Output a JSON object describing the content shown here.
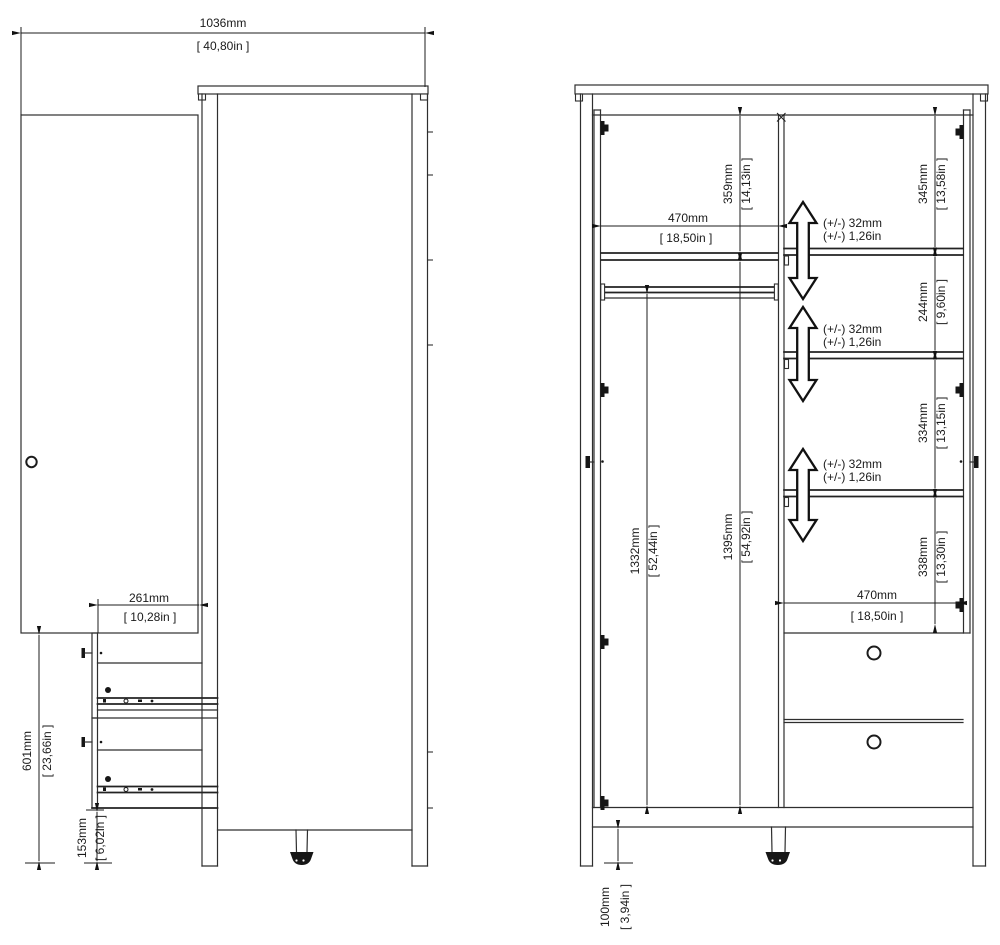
{
  "drawing": {
    "line_color": "#2e2e2e",
    "side_view": {
      "overall_width": {
        "mm": "1036mm",
        "in": "[ 40,80in ]"
      },
      "drawer_extension": {
        "mm": "261mm",
        "in": "[ 10,28in ]"
      },
      "lower_section_height": {
        "mm": "601mm",
        "in": "[ 23,66in ]"
      },
      "plinth_height": {
        "mm": "153mm",
        "in": "[ 6,02in ]"
      }
    },
    "front_view": {
      "left_interior_width": {
        "mm": "470mm",
        "in": "[ 18,50in ]"
      },
      "top_section_height": {
        "mm": "359mm",
        "in": "[ 14,13in ]"
      },
      "rail_clearance_height": {
        "mm": "1332mm",
        "in": "[ 52,44in ]"
      },
      "interior_height": {
        "mm": "1395mm",
        "in": "[ 54,92in ]"
      },
      "right_section_1": {
        "mm": "345mm",
        "in": "[ 13,58in ]"
      },
      "right_section_2": {
        "mm": "244mm",
        "in": "[ 9,60in ]"
      },
      "right_section_3": {
        "mm": "334mm",
        "in": "[ 13,15in ]"
      },
      "right_section_4": {
        "mm": "338mm",
        "in": "[ 13,30in ]"
      },
      "right_interior_width": {
        "mm": "470mm",
        "in": "[ 18,50in ]"
      },
      "foot_height": {
        "mm": "100mm",
        "in": "[ 3,94in ]"
      },
      "shelf_adjustability": {
        "mm": "(+/-) 32mm",
        "in": "(+/-) 1,26in"
      }
    }
  }
}
